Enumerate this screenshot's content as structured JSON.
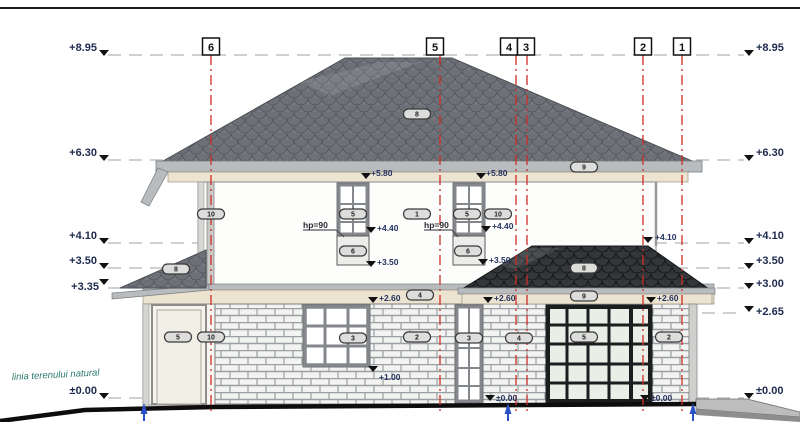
{
  "drawing_kind": "house side elevation",
  "left_levels": [
    "+8.95",
    "+6.30",
    "+4.10",
    "+3.50",
    "+3.35",
    "±0.00"
  ],
  "right_levels": [
    "+8.95",
    "+6.30",
    "+4.10",
    "+3.50",
    "+3.00",
    "+2.65",
    "±0.00"
  ],
  "grid_axes": [
    "6",
    "5",
    "4",
    "3",
    "2",
    "1"
  ],
  "ground_label": "linia terenului natural",
  "inline_levels": {
    "l580": "+5.80",
    "l440": "+4.40",
    "l350": "+3.50",
    "l410": "+4.10",
    "l260": "+2.60",
    "l100": "+1.00",
    "l000": "±0.00",
    "hp90": "hp=90"
  },
  "tags": {
    "t1": "1",
    "t2": "2",
    "t3": "3",
    "t4": "4",
    "t5": "5",
    "t6": "6",
    "t8": "8",
    "t9": "9",
    "t10": "10"
  },
  "colors": {
    "axis_red": "#cf2d26",
    "label_navy": "#1e2a4e",
    "ground_teal": "#2c7a6e",
    "roof_gray": "#75787e",
    "roof_dark": "#2e3134",
    "fascia_cream": "#ece3d0",
    "gutter_gray": "#b9bcbe",
    "arrow_blue": "#2a52c4"
  }
}
